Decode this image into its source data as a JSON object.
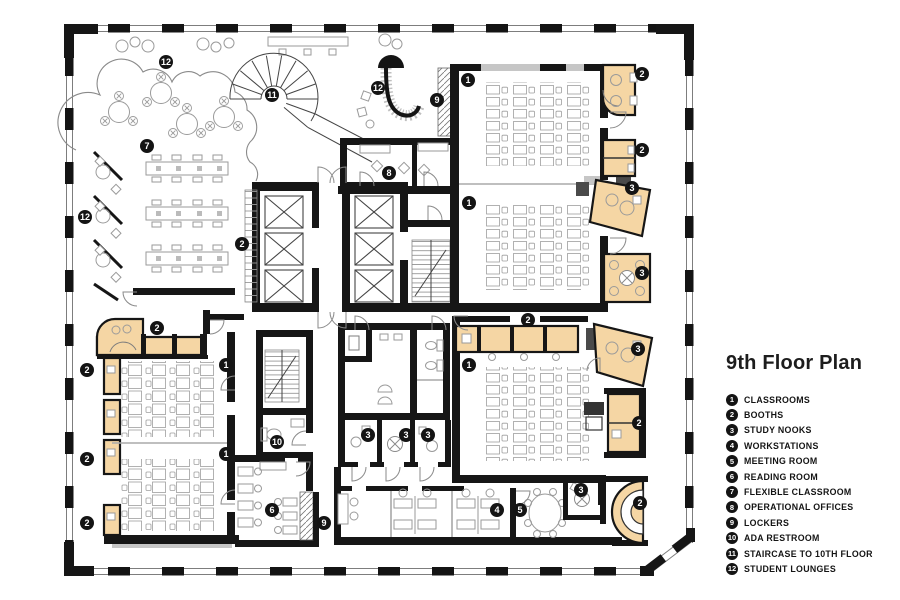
{
  "title": "9th Floor Plan",
  "colors": {
    "accent_tan": "#F5D6A4",
    "wall_black": "#141414",
    "furniture_gray": "#9A9A9A"
  },
  "legend": [
    {
      "n": "1",
      "label": "CLASSROOMS"
    },
    {
      "n": "2",
      "label": "BOOTHS"
    },
    {
      "n": "3",
      "label": "STUDY NOOKS"
    },
    {
      "n": "4",
      "label": "WORKSTATIONS"
    },
    {
      "n": "5",
      "label": "MEETING ROOM"
    },
    {
      "n": "6",
      "label": "READING ROOM"
    },
    {
      "n": "7",
      "label": "FLEXIBLE CLASSROOM"
    },
    {
      "n": "8",
      "label": "OPERATIONAL OFFICES"
    },
    {
      "n": "9",
      "label": "LOCKERS"
    },
    {
      "n": "10",
      "label": "ADA RESTROOM"
    },
    {
      "n": "11",
      "label": "STAIRCASE TO 10TH FLOOR"
    },
    {
      "n": "12",
      "label": "STUDENT LOUNGES"
    }
  ],
  "badges": [
    {
      "n": "12",
      "x": 166,
      "y": 62
    },
    {
      "n": "11",
      "x": 272,
      "y": 95
    },
    {
      "n": "12",
      "x": 378,
      "y": 88
    },
    {
      "n": "9",
      "x": 437,
      "y": 100
    },
    {
      "n": "1",
      "x": 468,
      "y": 80
    },
    {
      "n": "2",
      "x": 642,
      "y": 74
    },
    {
      "n": "7",
      "x": 147,
      "y": 146
    },
    {
      "n": "8",
      "x": 389,
      "y": 173
    },
    {
      "n": "2",
      "x": 642,
      "y": 150
    },
    {
      "n": "3",
      "x": 632,
      "y": 188
    },
    {
      "n": "1",
      "x": 469,
      "y": 203
    },
    {
      "n": "12",
      "x": 85,
      "y": 217
    },
    {
      "n": "2",
      "x": 242,
      "y": 244
    },
    {
      "n": "3",
      "x": 642,
      "y": 273
    },
    {
      "n": "2",
      "x": 157,
      "y": 328
    },
    {
      "n": "2",
      "x": 528,
      "y": 320
    },
    {
      "n": "3",
      "x": 638,
      "y": 349
    },
    {
      "n": "1",
      "x": 226,
      "y": 365
    },
    {
      "n": "1",
      "x": 469,
      "y": 365
    },
    {
      "n": "2",
      "x": 87,
      "y": 370
    },
    {
      "n": "2",
      "x": 639,
      "y": 423
    },
    {
      "n": "3",
      "x": 368,
      "y": 435
    },
    {
      "n": "3",
      "x": 406,
      "y": 435
    },
    {
      "n": "3",
      "x": 428,
      "y": 435
    },
    {
      "n": "10",
      "x": 277,
      "y": 442
    },
    {
      "n": "1",
      "x": 226,
      "y": 454
    },
    {
      "n": "2",
      "x": 87,
      "y": 459
    },
    {
      "n": "3",
      "x": 581,
      "y": 490
    },
    {
      "n": "2",
      "x": 640,
      "y": 503
    },
    {
      "n": "6",
      "x": 272,
      "y": 510
    },
    {
      "n": "4",
      "x": 497,
      "y": 510
    },
    {
      "n": "5",
      "x": 520,
      "y": 510
    },
    {
      "n": "2",
      "x": 87,
      "y": 523
    },
    {
      "n": "9",
      "x": 324,
      "y": 523
    }
  ]
}
